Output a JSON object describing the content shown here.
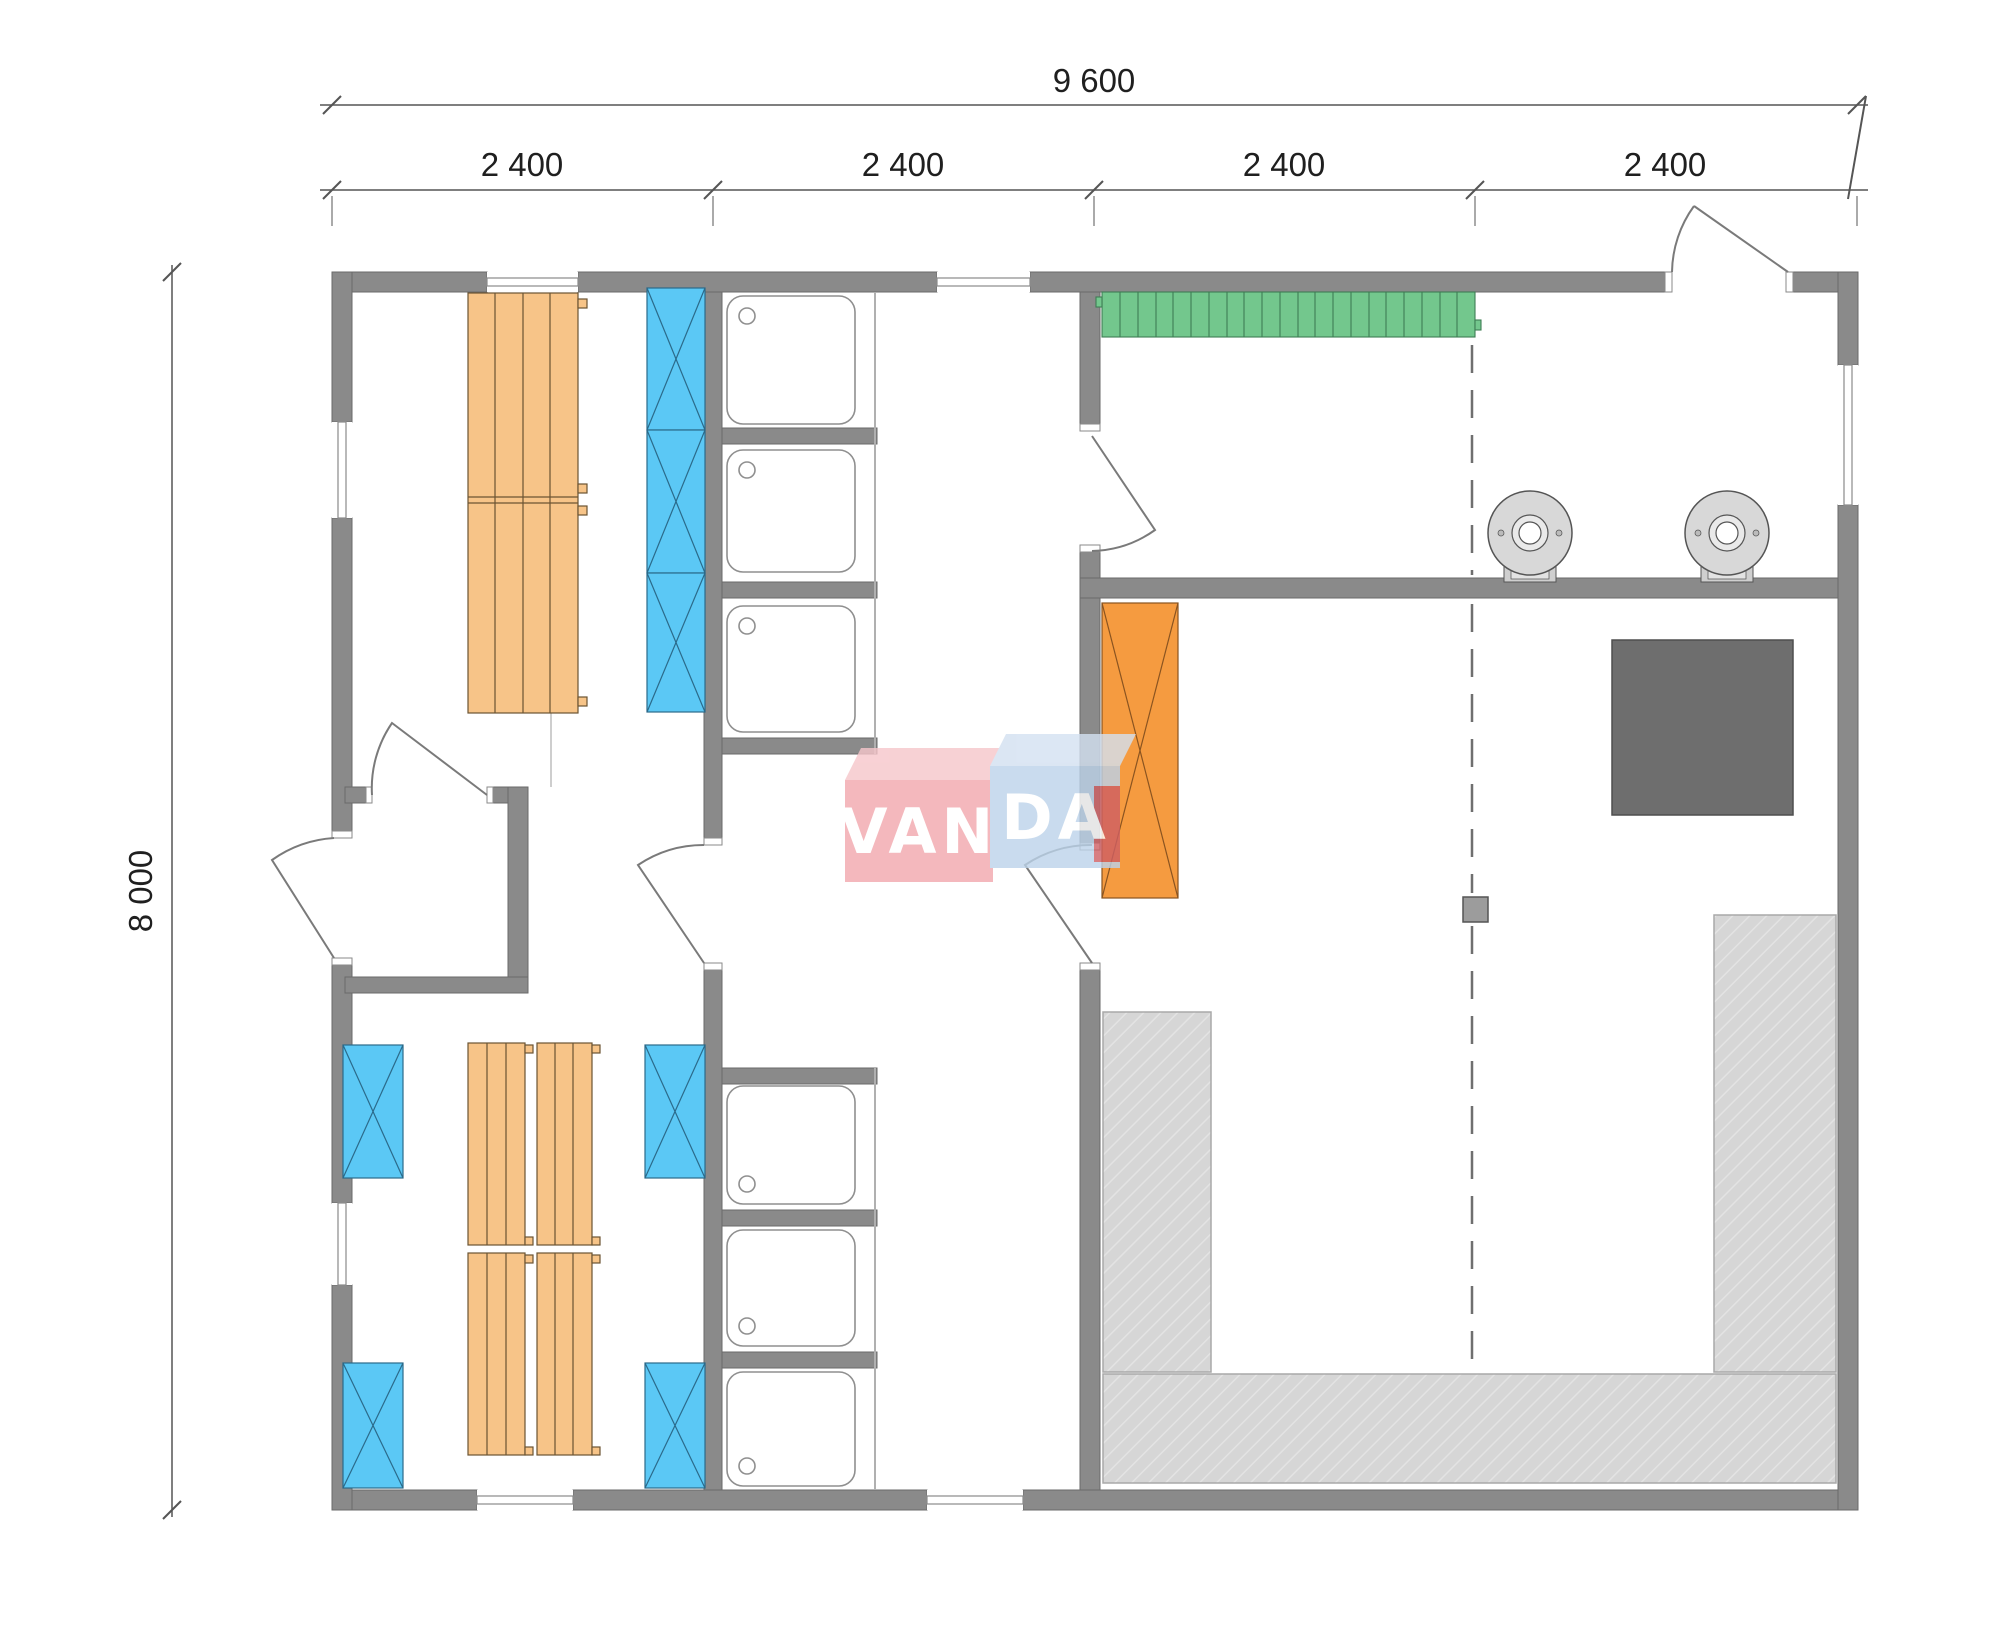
{
  "drawing": {
    "type": "sauna-bathhouse-floor-plan",
    "units": "mm"
  },
  "dimensions": {
    "overall_width": "9 600",
    "overall_height": "8 000",
    "top_segments": [
      "2 400",
      "2 400",
      "2 400",
      "2 400"
    ]
  },
  "watermark": {
    "left": "VAN",
    "right": "DA"
  },
  "colors": {
    "wall": "#8A8A8A",
    "wall_stroke": "#6A6A6A",
    "bench_wood": "#F7C488",
    "bench_wood_stroke": "#6B5433",
    "locker_blue": "#5BC8F5",
    "locker_blue_stroke": "#2B7DA3",
    "bench_green": "#73C78D",
    "bench_green_stroke": "#3E7D54",
    "locker_orange": "#F59B40",
    "locker_orange_stroke": "#8A5420",
    "stove_dark": "#6E6E6E",
    "hatch_fill": "#D6D6D6",
    "hatch_line": "#E3E3E3",
    "hatch_stroke": "#A9A9A9",
    "boiler_fill": "#D8D8D8",
    "shower_stroke": "#8F8F8F",
    "door_stroke": "#7A7A7A",
    "dash_line": "#6F6F6F",
    "watermark_pink": "#F2A7AD",
    "watermark_pink_top": "#F6C6CA",
    "watermark_blue": "#BCD3EA",
    "watermark_blue_top": "#D3E1F1",
    "watermark_red": "#CF5F63"
  },
  "fixtures_visible": {
    "shower_trays": 6,
    "wood_bench_units": 6,
    "blue_crossed_lockers": 7,
    "orange_crossed_locker": 1,
    "green_slatted_bench": 1,
    "hatched_platform_sections": 3,
    "round_boilers": 2,
    "stove_square": 1,
    "doors": 6,
    "windows": 7,
    "support_post": 1
  }
}
